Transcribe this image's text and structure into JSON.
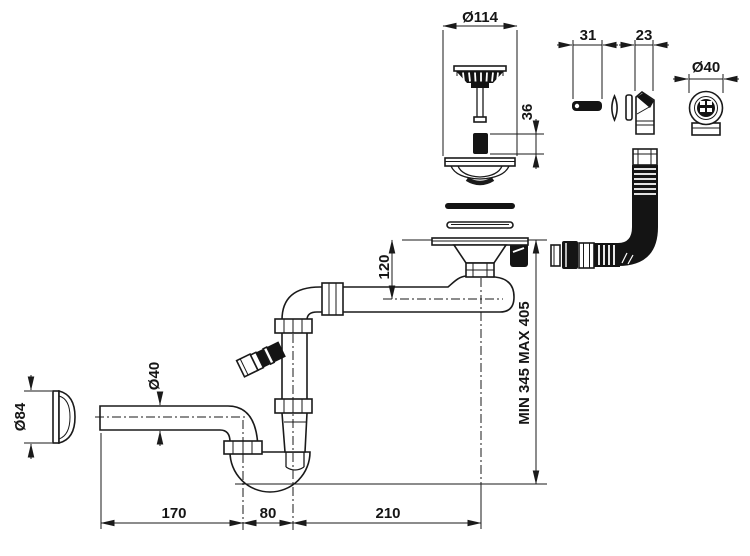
{
  "drawing": {
    "labels": {
      "strainer_dia": "Ø114",
      "seal_width": "31",
      "elbow_width": "23",
      "connector_dia": "Ø40",
      "plug_height": "36",
      "outlet_drop": "120",
      "install_height": "MIN 345 MAX 405",
      "cap_dia": "Ø84",
      "pipe_dia": "Ø40",
      "seg_left": "170",
      "seg_mid": "80",
      "seg_right": "210"
    },
    "colors": {
      "line": "#1a1a1a",
      "background": "#ffffff"
    }
  }
}
